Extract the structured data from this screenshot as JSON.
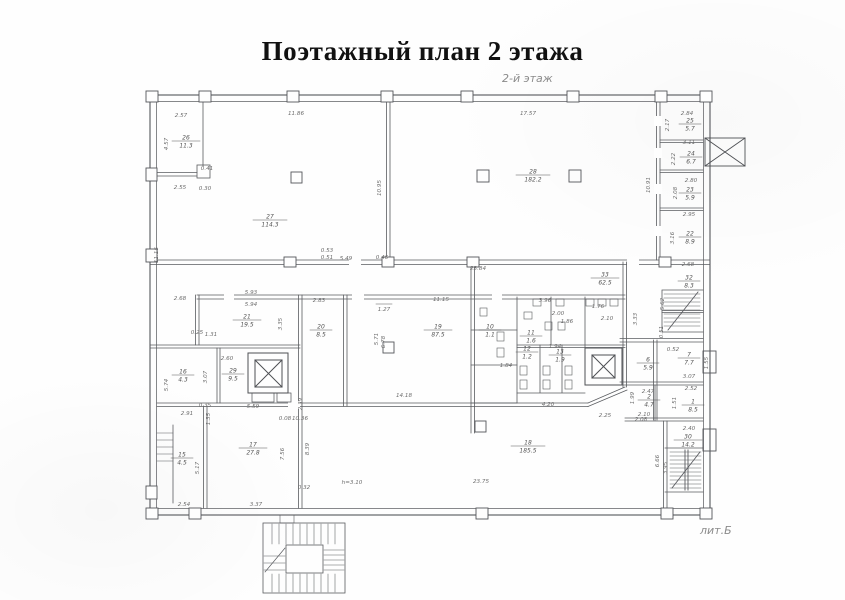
{
  "title": "Поэтажный план 2 этажа",
  "floor_label": "2-й этаж",
  "lit_label": "лит.Б",
  "colors": {
    "wall": "#54565a",
    "thin": "#6a6c70",
    "dim_text": "#6d6d6d",
    "room_text": "#555555",
    "title_text": "#111111",
    "muted": "#8b8b8b"
  },
  "legend": {
    "elevator_icon": "box with X diagonals",
    "staircase_icon": "hatched treads with diagonal"
  },
  "rooms": [
    {
      "num": "26",
      "area": "11.3",
      "x": 186,
      "y": 141
    },
    {
      "num": "27",
      "area": "114.3",
      "x": 270,
      "y": 220
    },
    {
      "num": "28",
      "area": "182.2",
      "x": 533,
      "y": 175
    },
    {
      "num": "25",
      "area": "5.7",
      "x": 690,
      "y": 124
    },
    {
      "num": "24",
      "area": "6.7",
      "x": 691,
      "y": 157
    },
    {
      "num": "23",
      "area": "5.9",
      "x": 690,
      "y": 193
    },
    {
      "num": "22",
      "area": "8.9",
      "x": 690,
      "y": 237
    },
    {
      "num": "21",
      "area": "19.5",
      "x": 247,
      "y": 320
    },
    {
      "num": "20",
      "area": "8.5",
      "x": 321,
      "y": 330
    },
    {
      "num": "19",
      "area": "87.5",
      "x": 438,
      "y": 330
    },
    {
      "num": "33",
      "area": "62.5",
      "x": 605,
      "y": 278
    },
    {
      "num": "32",
      "area": "8.3",
      "x": 689,
      "y": 281
    },
    {
      "num": "29",
      "area": "9.5",
      "x": 233,
      "y": 374
    },
    {
      "num": "16",
      "area": "4.3",
      "x": 183,
      "y": 375
    },
    {
      "num": "15",
      "area": "4.5",
      "x": 182,
      "y": 458
    },
    {
      "num": "17",
      "area": "27.8",
      "x": 253,
      "y": 448
    },
    {
      "num": "18",
      "area": "185.5",
      "x": 528,
      "y": 446
    },
    {
      "num": "30",
      "area": "14.2",
      "x": 688,
      "y": 440
    },
    {
      "num": "7",
      "area": "7.7",
      "x": 689,
      "y": 358
    },
    {
      "num": "1",
      "area": "8.5",
      "x": 693,
      "y": 405
    },
    {
      "num": "6",
      "area": "5.9",
      "x": 648,
      "y": 363
    },
    {
      "num": "2",
      "area": "4.7",
      "x": 649,
      "y": 400
    },
    {
      "num": "10",
      "area": "1.1",
      "x": 490,
      "y": 330
    },
    {
      "num": "11",
      "area": "1.6",
      "x": 531,
      "y": 336
    },
    {
      "num": "12",
      "area": "1.2",
      "x": 527,
      "y": 352
    },
    {
      "num": "13",
      "area": "1.9",
      "x": 560,
      "y": 355
    }
  ],
  "dims": [
    {
      "t": "2.57",
      "x": 181,
      "y": 117
    },
    {
      "t": "11.86",
      "x": 296,
      "y": 115
    },
    {
      "t": "17.57",
      "x": 528,
      "y": 115
    },
    {
      "t": "2.84",
      "x": 687,
      "y": 115
    },
    {
      "t": "2.17",
      "x": 669,
      "y": 125,
      "v": 1
    },
    {
      "t": "3.11",
      "x": 689,
      "y": 144
    },
    {
      "t": "2.22",
      "x": 675,
      "y": 159,
      "v": 1
    },
    {
      "t": "2.80",
      "x": 691,
      "y": 182
    },
    {
      "t": "2.08",
      "x": 677,
      "y": 193,
      "v": 1
    },
    {
      "t": "2.95",
      "x": 689,
      "y": 216
    },
    {
      "t": "3.16",
      "x": 674,
      "y": 238,
      "v": 1
    },
    {
      "t": "10.95",
      "x": 381,
      "y": 188,
      "v": 1
    },
    {
      "t": "10.91",
      "x": 650,
      "y": 185,
      "v": 1
    },
    {
      "t": "4.57",
      "x": 168,
      "y": 144,
      "v": 1
    },
    {
      "t": "0.41",
      "x": 207,
      "y": 170
    },
    {
      "t": "2.55",
      "x": 180,
      "y": 189
    },
    {
      "t": "0.30",
      "x": 205,
      "y": 190
    },
    {
      "t": "11.15",
      "x": 158,
      "y": 255,
      "v": 1
    },
    {
      "t": "2.68",
      "x": 180,
      "y": 300
    },
    {
      "t": "5.93",
      "x": 251,
      "y": 294
    },
    {
      "t": "5.94",
      "x": 251,
      "y": 306
    },
    {
      "t": "3.35",
      "x": 282,
      "y": 324,
      "v": 1
    },
    {
      "t": "0.25",
      "x": 197,
      "y": 334
    },
    {
      "t": "1.31",
      "x": 211,
      "y": 336
    },
    {
      "t": "2.60",
      "x": 227,
      "y": 360
    },
    {
      "t": "3.07",
      "x": 207,
      "y": 377,
      "v": 1
    },
    {
      "t": "5.74",
      "x": 168,
      "y": 385,
      "v": 1
    },
    {
      "t": "5.59",
      "x": 253,
      "y": 408
    },
    {
      "t": "0.35",
      "x": 205,
      "y": 407
    },
    {
      "t": "2.91",
      "x": 187,
      "y": 415
    },
    {
      "t": "1.35",
      "x": 210,
      "y": 419,
      "v": 1
    },
    {
      "t": "5.17",
      "x": 199,
      "y": 468,
      "v": 1
    },
    {
      "t": "2.54",
      "x": 184,
      "y": 506
    },
    {
      "t": "3.37",
      "x": 256,
      "y": 506
    },
    {
      "t": "7.56",
      "x": 284,
      "y": 454,
      "v": 1
    },
    {
      "t": "0.32",
      "x": 304,
      "y": 489
    },
    {
      "t": "h=3.10",
      "x": 352,
      "y": 484
    },
    {
      "t": "23.75",
      "x": 481,
      "y": 483
    },
    {
      "t": "0.08",
      "x": 285,
      "y": 420
    },
    {
      "t": "10.36",
      "x": 300,
      "y": 420
    },
    {
      "t": "2.39",
      "x": 302,
      "y": 404,
      "v": 1
    },
    {
      "t": "8.39",
      "x": 309,
      "y": 449,
      "v": 1
    },
    {
      "t": "14.18",
      "x": 404,
      "y": 397
    },
    {
      "t": "0.53",
      "x": 327,
      "y": 252
    },
    {
      "t": "0.51",
      "x": 327,
      "y": 259
    },
    {
      "t": "5.49",
      "x": 346,
      "y": 260
    },
    {
      "t": "0.46",
      "x": 382,
      "y": 259
    },
    {
      "t": "23.84",
      "x": 478,
      "y": 270
    },
    {
      "t": "2.68",
      "x": 688,
      "y": 266
    },
    {
      "t": "2.83",
      "x": 319,
      "y": 302
    },
    {
      "t": "1.27",
      "x": 384,
      "y": 311,
      "o": 1
    },
    {
      "t": "11.15",
      "x": 441,
      "y": 301
    },
    {
      "t": "5.71",
      "x": 378,
      "y": 339,
      "v": 1
    },
    {
      "t": "6.78",
      "x": 385,
      "y": 342,
      "v": 1
    },
    {
      "t": "3.96",
      "x": 545,
      "y": 302
    },
    {
      "t": "1.76",
      "x": 598,
      "y": 308
    },
    {
      "t": "2.00",
      "x": 558,
      "y": 315
    },
    {
      "t": "1.86",
      "x": 567,
      "y": 323
    },
    {
      "t": "1.94",
      "x": 555,
      "y": 348
    },
    {
      "t": "1.84",
      "x": 506,
      "y": 367
    },
    {
      "t": "2.10",
      "x": 607,
      "y": 320
    },
    {
      "t": "3.33",
      "x": 637,
      "y": 319,
      "v": 1
    },
    {
      "t": "5.62",
      "x": 664,
      "y": 304,
      "v": 1
    },
    {
      "t": "0.51",
      "x": 663,
      "y": 332,
      "v": 1
    },
    {
      "t": "0.52",
      "x": 673,
      "y": 351
    },
    {
      "t": "1.55",
      "x": 708,
      "y": 363,
      "v": 1
    },
    {
      "t": "3.07",
      "x": 689,
      "y": 378
    },
    {
      "t": "2.52",
      "x": 691,
      "y": 390
    },
    {
      "t": "1.51",
      "x": 676,
      "y": 403,
      "v": 1
    },
    {
      "t": "2.47",
      "x": 648,
      "y": 393
    },
    {
      "t": "1.99",
      "x": 634,
      "y": 398,
      "v": 1
    },
    {
      "t": "2.10",
      "x": 644,
      "y": 416
    },
    {
      "t": "4.20",
      "x": 548,
      "y": 406
    },
    {
      "t": "2.25",
      "x": 605,
      "y": 417
    },
    {
      "t": "2.08",
      "x": 641,
      "y": 421
    },
    {
      "t": "2.40",
      "x": 689,
      "y": 430
    },
    {
      "t": "3.95",
      "x": 667,
      "y": 468,
      "v": 1
    },
    {
      "t": "6.66",
      "x": 659,
      "y": 461,
      "v": 1
    }
  ]
}
